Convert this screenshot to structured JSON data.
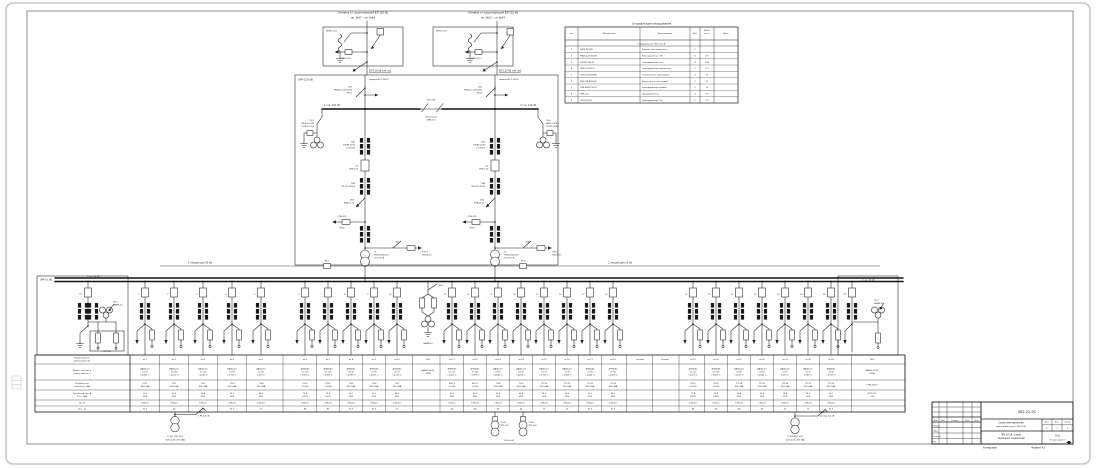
{
  "footer": {
    "kopiroval": "Копировал",
    "format": "Формат А1"
  },
  "spec_table": {
    "title": "Спецификация оборудования",
    "headers": [
      "поз.",
      "Обозначение",
      "Наименование",
      "Кол.",
      "Масса|ед. кг",
      "Прим."
    ],
    "section": "Оборудование ОРУ-110 кВ",
    "rows": [
      [
        "1",
        "2КВЭ-110-РН",
        "Ячейка с выключателем",
        "2",
        "",
        ""
      ],
      [
        "2",
        "РНДЗ-2-110/1000",
        "Разъединитель с ЗН",
        "4",
        "175",
        ""
      ],
      [
        "3",
        "ТФЗМ-110Б-У1",
        "Трансформатор тока",
        "4",
        "178",
        ""
      ],
      [
        "4",
        "НКФ-110-83-У1",
        "Трансформатор напряжения",
        "2",
        "171",
        ""
      ],
      [
        "5",
        "ОПН-110/56-УХЛ1",
        "Ограничитель перенапряж.",
        "4",
        "92",
        ""
      ],
      [
        "6",
        "ВЭБ-110-40/2000",
        "Выключатель элегазовый",
        "2",
        "2,1",
        ""
      ],
      [
        "7",
        "ТМН-6300/110-У1",
        "Трансформатор силовой",
        "2",
        "10",
        ""
      ],
      [
        "8",
        "ПКН-110",
        "Предохранитель",
        "4",
        "0,5",
        ""
      ],
      [
        "9",
        "ТМ-63/10-У1",
        "Трансформатор ТСН",
        "2",
        "1,2",
        ""
      ]
    ]
  },
  "feeder_table": {
    "row_headers": [
      "Наименование|присоединения",
      "Марка, сечение и|длина кабеля, м",
      "Потребитель,|мощность, кВА",
      "Расчётный ток, А|Кт.т., А/А",
      "Тип ТТ",
      "Iвст., А"
    ],
    "columns": [
      {
        "x": 145,
        "v": [
          "яч.1",
          "ААШв-10|3×95|L=185 м",
          "РП-1|400 кВА",
          "23,1|50/5",
          "ТЛК-10",
          "31,5"
        ]
      },
      {
        "x": 174,
        "v": [
          "яч.2",
          "ААШв-10|3×120|L=210 м",
          "ТП-1|630 кВА",
          "36,4|50/5",
          "ТЛК-10",
          "40"
        ]
      },
      {
        "x": 203,
        "v": [
          "яч.3",
          "ААШв-10|3×120|L=240 м",
          "ТП-2|630 кВА",
          "36,4|50/5",
          "ТЛК-10",
          "40"
        ]
      },
      {
        "x": 232,
        "v": [
          "яч.4",
          "ААШв-10|3×95|L=160 м",
          "ТП-3|400 кВА",
          "23,1|30/5",
          "ТЛК-10",
          "31,5"
        ]
      },
      {
        "x": 261,
        "v": [
          "яч.5",
          "ААШв-10|3×70|L=95 м",
          "ТП-4|250 кВА",
          "14,5|20/5",
          "ТЛК-10",
          "20"
        ]
      },
      {
        "x": 305,
        "v": [
          "яч.6",
          "АПвБШв|3×120|L=320 м",
          "РП-2|2×630",
          "72,8|100/5",
          "ТЛК-10",
          "80"
        ]
      },
      {
        "x": 328,
        "v": [
          "яч.7",
          "АПвБШв|3×120|L=305 м",
          "РП-2|2×630",
          "72,8|100/5",
          "ТЛК-10",
          "80"
        ]
      },
      {
        "x": 351,
        "v": [
          "яч.8",
          "АПвБШв|3×95|L=280 м",
          "ТП-5|400 кВА",
          "23,1|30/5",
          "ТЛК-10",
          "31,5"
        ]
      },
      {
        "x": 374,
        "v": [
          "яч.9",
          "АПвБШв|3×95|L=265 м",
          "ТП-6|400 кВА",
          "23,1|30/5",
          "ТЛК-10",
          "31,5"
        ]
      },
      {
        "x": 397,
        "v": [
          "яч.10",
          "АПвБШв|3×70|L=120 м",
          "ТП-7|250 кВА",
          "14,5|20/5",
          "ТЛК-10",
          "20"
        ]
      },
      {
        "x": 428,
        "v": [
          "ТН-1",
          "НАМИ-10-95|УХЛ4",
          "",
          "",
          "",
          ""
        ]
      },
      {
        "x": 452,
        "v": [
          "яч.11",
          "АПвБШв|3×120|L=410 м",
          "КНС-1|2×320",
          "37,0|50/5",
          "ТЛК-10",
          "40"
        ]
      },
      {
        "x": 475,
        "v": [
          "яч.12",
          "АПвБШв|3×120|L=395 м",
          "КНС-1|2×320",
          "37,0|50/5",
          "ТЛК-10",
          "40"
        ]
      },
      {
        "x": 498,
        "v": [
          "яч.13",
          "ААШв-10|3×95|L=240 м",
          "ТП-8|630 кВА",
          "36,4|50/5",
          "ТЛК-10",
          "40"
        ]
      },
      {
        "x": 521,
        "v": [
          "яч.14",
          "ААШв-10|3×95|L=225 м",
          "ТП-9|630 кВА",
          "36,4|50/5",
          "ТЛК-10",
          "40"
        ]
      },
      {
        "x": 544,
        "v": [
          "яч.15",
          "ААШв-10|3×70|L=180 м",
          "ТП-10|250 кВА",
          "14,5|20/5",
          "ТЛК-10",
          "20"
        ]
      },
      {
        "x": 567,
        "v": [
          "яч.16",
          "ААШв-10|3×70|L=165 м",
          "ТП-11|250 кВА",
          "14,5|20/5",
          "ТЛК-10",
          "20"
        ]
      },
      {
        "x": 590,
        "v": [
          "яч.17",
          "АПвБШв|3×95|L=340 м",
          "ТП-12|400 кВА",
          "23,1|30/5",
          "ТЛК-10",
          "31,5"
        ]
      },
      {
        "x": 613,
        "v": [
          "яч.18",
          "АПвБШв|3×95|L=355 м",
          "ТП-13|400 кВА",
          "23,1|30/5",
          "ТЛК-10",
          "31,5"
        ]
      },
      {
        "x": 640,
        "v": [
          "резерв",
          "",
          "",
          "",
          "",
          ""
        ]
      },
      {
        "x": 665,
        "v": [
          "резерв",
          "",
          "",
          "",
          "",
          ""
        ]
      },
      {
        "x": 693,
        "v": [
          "яч.19",
          "АПвБШв|3×120|L=520 м",
          "РП-3|2×630",
          "72,8|100/5",
          "ТЛК-10",
          "80"
        ]
      },
      {
        "x": 716,
        "v": [
          "яч.20",
          "АПвБШв|3×120|L=505 м",
          "РП-3|2×630",
          "72,8|100/5",
          "ТЛК-10",
          "80"
        ]
      },
      {
        "x": 739,
        "v": [
          "яч.21",
          "ААШв-10|3×95|L=130 м",
          "ТП-14|630 кВА",
          "36,4|50/5",
          "ТЛК-10",
          "40"
        ]
      },
      {
        "x": 762,
        "v": [
          "яч.22",
          "ААШв-10|3×95|L=145 м",
          "ТП-15|630 кВА",
          "36,4|50/5",
          "ТЛК-10",
          "40"
        ]
      },
      {
        "x": 785,
        "v": [
          "яч.23",
          "ААШв-10|3×70|L=90 м",
          "ТП-16|250 кВА",
          "14,5|20/5",
          "ТЛК-10",
          "20"
        ]
      },
      {
        "x": 808,
        "v": [
          "яч.24",
          "ААШв-10|3×70|L=85 м",
          "ТП-17|250 кВА",
          "14,5|20/5",
          "ТЛК-10",
          "20"
        ]
      },
      {
        "x": 831,
        "v": [
          "яч.25",
          "АПвБШв|3×95|L=310 м",
          "ТП-18|400 кВА",
          "23,1|30/5",
          "ТЛК-10",
          "31,5"
        ]
      },
      {
        "x": 872,
        "v": [
          "ТН-2",
          "НАМИ-10-95|УХЛ4",
          "ОПН-10/12",
          "ПКТ-101|2 А",
          "",
          ""
        ]
      }
    ]
  },
  "bays": [
    {
      "x": 145,
      "label": "1"
    },
    {
      "x": 174,
      "label": "2"
    },
    {
      "x": 203,
      "label": "3"
    },
    {
      "x": 232,
      "label": "4"
    },
    {
      "x": 261,
      "label": "5"
    },
    {
      "x": 305,
      "label": "6"
    },
    {
      "x": 328,
      "label": "7"
    },
    {
      "x": 351,
      "label": "8"
    },
    {
      "x": 374,
      "label": "9"
    },
    {
      "x": 397,
      "label": "10"
    },
    {
      "x": 452,
      "label": "11"
    },
    {
      "x": 475,
      "label": "12"
    },
    {
      "x": 498,
      "label": "13"
    },
    {
      "x": 521,
      "label": "14"
    },
    {
      "x": 544,
      "label": "15"
    },
    {
      "x": 567,
      "label": "16"
    },
    {
      "x": 590,
      "label": "17"
    },
    {
      "x": 613,
      "label": "18"
    },
    {
      "x": 693,
      "label": "19"
    },
    {
      "x": 716,
      "label": "20"
    },
    {
      "x": 739,
      "label": "21"
    },
    {
      "x": 762,
      "label": "22"
    },
    {
      "x": 785,
      "label": "23"
    },
    {
      "x": 808,
      "label": "24"
    },
    {
      "x": 831,
      "label": "25"
    }
  ],
  "ann": [
    {
      "x": 363,
      "y": 13.5,
      "t": "Отпайка от существующей ВЛ-110 кВ",
      "s": 2.5
    },
    {
      "x": 363,
      "y": 18.5,
      "t": "оп. №47 – оп. №48",
      "s": 2.5
    },
    {
      "x": 493,
      "y": 13.5,
      "t": "Отпайка от существующей ВЛ-110 кВ",
      "s": 2.5
    },
    {
      "x": 493,
      "y": 18.5,
      "t": "оп. №53 – оп. №54",
      "s": 2.5
    },
    {
      "x": 326,
      "y": 31.5,
      "t": "ЯКНО-110",
      "s": 2.1,
      "a": "s"
    },
    {
      "x": 436,
      "y": 31.5,
      "t": "ЯКНО-110",
      "s": 2.1,
      "a": "s"
    },
    {
      "x": 346,
      "y": 59,
      "t": "ПКН-110",
      "s": 2
    },
    {
      "x": 476,
      "y": 59,
      "t": "ПКН-110",
      "s": 2
    },
    {
      "x": 369,
      "y": 71.5,
      "t": "ВЛ-110 кВ отп. №1",
      "s": 2.3,
      "a": "s",
      "u": 1
    },
    {
      "x": 499,
      "y": 71.5,
      "t": "ВЛ-110 кВ отп. №2",
      "s": 2.3,
      "a": "s",
      "u": 1
    },
    {
      "x": 369,
      "y": 80,
      "t": "провод АС-120/19",
      "s": 2.1,
      "a": "s"
    },
    {
      "x": 499,
      "y": 80,
      "t": "провод АС-120/19",
      "s": 2.1,
      "a": "s"
    },
    {
      "x": 352,
      "y": 87.5,
      "t": "QS1|РНДЗ-2-110/1000|УХЛ1",
      "s": 2,
      "a": "e"
    },
    {
      "x": 482,
      "y": 87.5,
      "t": "QS2|РНДЗ-2-110/1000|УХЛ1",
      "s": 2,
      "a": "e"
    },
    {
      "x": 298,
      "y": 80.5,
      "t": "ОРУ-110 кВ",
      "s": 2.5,
      "a": "s"
    },
    {
      "x": 324,
      "y": 106,
      "t": "1 с.ш. 110 кВ",
      "s": 2.3,
      "a": "s"
    },
    {
      "x": 536,
      "y": 106,
      "t": "2 с.ш. 110 кВ",
      "s": 2.3,
      "a": "e"
    },
    {
      "x": 431,
      "y": 100.5,
      "t": "QS5 QS6",
      "s": 2
    },
    {
      "x": 431,
      "y": 117.5,
      "t": "перемычка|СМВ-110",
      "s": 2
    },
    {
      "x": 314,
      "y": 121,
      "t": "ТН-1|НКФ-110-83|ОПН-110/56",
      "s": 2,
      "a": "e"
    },
    {
      "x": 546,
      "y": 121,
      "t": "ТН-2|НКФ-110-83|ОПН-110/56",
      "s": 2,
      "a": "s"
    },
    {
      "x": 355,
      "y": 142.5,
      "t": "ТА1|ТФЗМ-110Б|2×300/5",
      "s": 2,
      "a": "e"
    },
    {
      "x": 485,
      "y": 142.5,
      "t": "ТА2|ТФЗМ-110Б|2×300/5",
      "s": 2,
      "a": "e"
    },
    {
      "x": 358,
      "y": 166.5,
      "t": "Q1|ВЭБ-110",
      "s": 2,
      "a": "e"
    },
    {
      "x": 488,
      "y": 166.5,
      "t": "Q2|ВЭБ-110",
      "s": 2,
      "a": "e"
    },
    {
      "x": 355,
      "y": 184,
      "t": "ТА3|ТВ-110-300/5",
      "s": 2,
      "a": "e"
    },
    {
      "x": 485,
      "y": 184,
      "t": "ТА4|ТВ-110-300/5",
      "s": 2,
      "a": "e"
    },
    {
      "x": 354,
      "y": 200.5,
      "t": "QS3|РНДЗ-110",
      "s": 2,
      "a": "e"
    },
    {
      "x": 484,
      "y": 200.5,
      "t": "QS4|РНДЗ-110",
      "s": 2,
      "a": "e"
    },
    {
      "x": 342,
      "y": 217,
      "t": "ОПН-110",
      "s": 2
    },
    {
      "x": 342,
      "y": 228.5,
      "t": "УХЛ1",
      "s": 2
    },
    {
      "x": 472,
      "y": 217,
      "t": "ОПН-110",
      "s": 2
    },
    {
      "x": 472,
      "y": 228.5,
      "t": "УХЛ1",
      "s": 2
    },
    {
      "x": 397,
      "y": 242.5,
      "t": "QS7",
      "s": 2
    },
    {
      "x": 527,
      "y": 242.5,
      "t": "QS8",
      "s": 2
    },
    {
      "x": 422,
      "y": 252.5,
      "t": "ТСН-1|ТМ-63/10",
      "s": 2,
      "a": "s"
    },
    {
      "x": 552,
      "y": 252.5,
      "t": "ТСН-2|ТМ-63/10",
      "s": 2,
      "a": "s"
    },
    {
      "x": 374,
      "y": 252.5,
      "t": "Т1|ТМН-6300/110|110/11 кВ",
      "s": 2,
      "a": "s"
    },
    {
      "x": 504,
      "y": 252.5,
      "t": "Т2|ТМН-6300/110|110/11 кВ",
      "s": 2,
      "a": "s"
    },
    {
      "x": 200,
      "y": 263.5,
      "t": "1 секция шин 10 кВ",
      "s": 2.3
    },
    {
      "x": 620,
      "y": 263.5,
      "t": "2 секция шин 10 кВ",
      "s": 2.3
    },
    {
      "x": 327,
      "y": 261.5,
      "t": "ЛР-1",
      "s": 1.9
    },
    {
      "x": 523,
      "y": 261.5,
      "t": "ЛР-2",
      "s": 1.9
    },
    {
      "x": 40,
      "y": 280.5,
      "t": "ЗРУ-10 кВ",
      "s": 2.3,
      "a": "s"
    },
    {
      "x": 93,
      "y": 277.2,
      "t": "1 с.ш. 10 кВ",
      "s": 2.1
    },
    {
      "x": 82,
      "y": 294.5,
      "t": "Q1",
      "s": 2,
      "a": "e"
    },
    {
      "x": 113,
      "y": 302.5,
      "t": "ТН-1|НАМИ-10",
      "s": 2,
      "a": "s"
    },
    {
      "x": 107,
      "y": 352,
      "t": "ПКТ-101",
      "s": 1.9
    },
    {
      "x": 846,
      "y": 294.5,
      "t": "Q2",
      "s": 2,
      "a": "e"
    },
    {
      "x": 874,
      "y": 301,
      "t": "ТН-2|НАМИ-10",
      "s": 2,
      "a": "s"
    },
    {
      "x": 868,
      "y": 280.5,
      "t": "2 с.ш. 10 кВ",
      "s": 2.1
    },
    {
      "x": 438,
      "y": 286,
      "t": "ТН-1с",
      "s": 1.9,
      "a": "s"
    },
    {
      "x": 428,
      "y": 344,
      "t": "НАМИ-10",
      "s": 1.9
    },
    {
      "x": 198,
      "y": 413,
      "t": "QW1",
      "s": 1.9,
      "a": "s"
    },
    {
      "x": 198,
      "y": 416.5,
      "t": "в РУ-0,4 кВ",
      "s": 2,
      "a": "s"
    },
    {
      "x": 175,
      "y": 437,
      "t": "ТСН-1 ТМГ-250",
      "s": 2
    },
    {
      "x": 175,
      "y": 440.3,
      "t": "10/0,4 кВ; 250 кВА",
      "s": 2
    },
    {
      "x": 500.5,
      "y": 423,
      "t": "ТСН-2|ТМГ-100",
      "s": 1.9,
      "a": "s"
    },
    {
      "x": 528.5,
      "y": 423,
      "t": "ТСН-3|ТМГ-100",
      "s": 1.9,
      "a": "s"
    },
    {
      "x": 509,
      "y": 441,
      "t": "10/0,4 кВ",
      "s": 2
    },
    {
      "x": 820,
      "y": 413,
      "t": "QW2",
      "s": 1.9,
      "a": "s"
    },
    {
      "x": 820,
      "y": 416.5,
      "t": "резерв 0,4 кВ",
      "s": 2,
      "a": "s"
    },
    {
      "x": 795,
      "y": 437,
      "t": "ТСН-4 ТМГ-250",
      "s": 2
    },
    {
      "x": 795,
      "y": 440.3,
      "t": "10/0,4 кВ; 250 кВА",
      "s": 2
    },
    {
      "x": 1027,
      "y": 413,
      "t": "082-21-ЭС",
      "s": 3.4,
      "n": "tb-doc-code"
    },
    {
      "x": 1011,
      "y": 423.5,
      "t": "Схема электрическая",
      "s": 2.2,
      "n": "tb-title-1"
    },
    {
      "x": 1011,
      "y": 427,
      "t": "принципиальная 110/10 кВ",
      "s": 2.1,
      "n": "tb-title-2"
    },
    {
      "x": 1011,
      "y": 435.5,
      "t": "ЗРУ-10 кВ. Схема",
      "s": 2.2,
      "n": "tb-subtitle-1"
    },
    {
      "x": 1011,
      "y": 439,
      "t": "первичных соединений",
      "s": 2.2,
      "n": "tb-subtitle-2"
    },
    {
      "x": 1047,
      "y": 422.5,
      "t": "Лит.",
      "s": 1.8
    },
    {
      "x": 1057,
      "y": 422.5,
      "t": "Лист",
      "s": 1.8
    },
    {
      "x": 1067.5,
      "y": 422.5,
      "t": "Листов",
      "s": 1.6
    },
    {
      "x": 1047,
      "y": 428.8,
      "t": "Р",
      "s": 2
    },
    {
      "x": 1057,
      "y": 428.8,
      "t": "1",
      "s": 2
    },
    {
      "x": 1067.5,
      "y": 428.8,
      "t": "1",
      "s": 2
    },
    {
      "x": 1057.5,
      "y": 436.5,
      "t": "ООО",
      "s": 2.2,
      "n": "tb-org-1"
    },
    {
      "x": 1057.5,
      "y": 440.3,
      "t": "«Энергопроект»",
      "s": 2,
      "n": "tb-org-2"
    },
    {
      "x": 935.5,
      "y": 420.8,
      "t": "Изм",
      "s": 1.6
    },
    {
      "x": 943,
      "y": 420.8,
      "t": "Лист",
      "s": 1.6
    },
    {
      "x": 955,
      "y": 420.8,
      "t": "№ докум.",
      "s": 1.6
    },
    {
      "x": 967.5,
      "y": 420.8,
      "t": "Подп.",
      "s": 1.6
    },
    {
      "x": 976.5,
      "y": 420.8,
      "t": "Дата",
      "s": 1.6
    },
    {
      "x": 933,
      "y": 426.3,
      "t": "Разраб.",
      "s": 1.8,
      "a": "s"
    },
    {
      "x": 933,
      "y": 431.6,
      "t": "Пров.",
      "s": 1.8,
      "a": "s"
    },
    {
      "x": 933,
      "y": 437,
      "t": "Н.контр.",
      "s": 1.8,
      "a": "s"
    },
    {
      "x": 933,
      "y": 442.4,
      "t": "Утв.",
      "s": 1.8,
      "a": "s"
    }
  ]
}
